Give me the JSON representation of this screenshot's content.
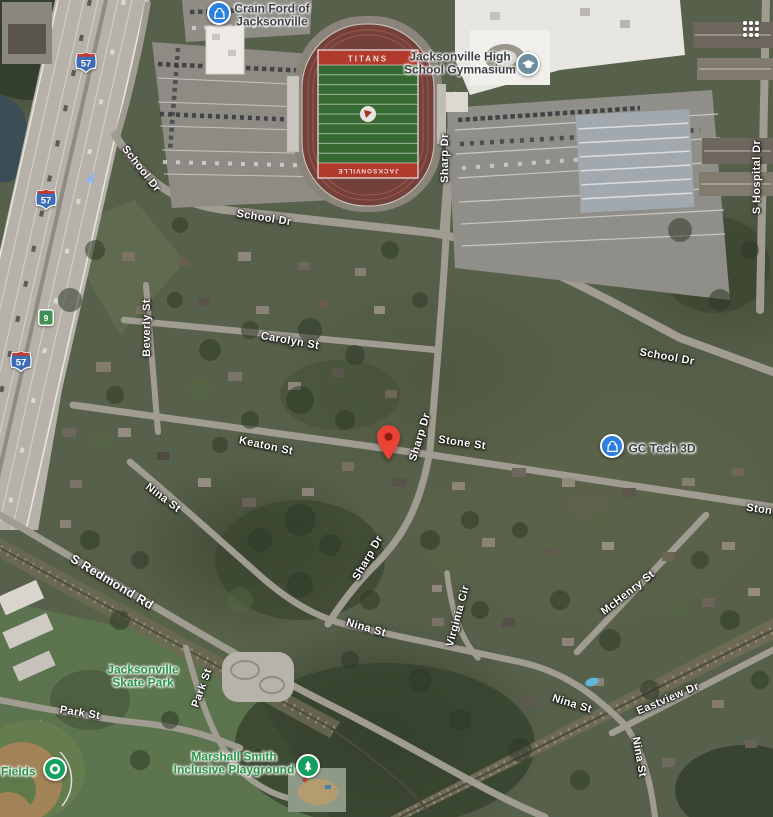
{
  "view": {
    "kind": "satellite-map",
    "city": "Jacksonville"
  },
  "controls": {
    "apps_grid_icon": "apps-grid"
  },
  "marker": {
    "name": "selected-location-pin",
    "color": "#EA4335"
  },
  "stadium": {
    "endzone_top": "TITANS",
    "endzone_bottom": "JACKSONVILLE"
  },
  "shields": [
    {
      "type": "interstate",
      "number": "57",
      "x": 86,
      "y": 64
    },
    {
      "type": "interstate",
      "number": "57",
      "x": 46,
      "y": 201
    },
    {
      "type": "state",
      "number": "9",
      "x": 46,
      "y": 320
    },
    {
      "type": "interstate",
      "number": "57",
      "x": 21,
      "y": 363
    }
  ],
  "street_labels": [
    {
      "text": "School Dr",
      "x": 141,
      "y": 169,
      "rot": 52
    },
    {
      "text": "School Dr",
      "x": 264,
      "y": 218,
      "rot": 9
    },
    {
      "text": "School Dr",
      "x": 667,
      "y": 357,
      "rot": 10
    },
    {
      "text": "Sharp Dr",
      "x": 445,
      "y": 158,
      "rot": -90
    },
    {
      "text": "Sharp Dr",
      "x": 420,
      "y": 437,
      "rot": -73
    },
    {
      "text": "Sharp Dr",
      "x": 368,
      "y": 558,
      "rot": -60
    },
    {
      "text": "Beverly St",
      "x": 147,
      "y": 328,
      "rot": -90
    },
    {
      "text": "Carolyn St",
      "x": 290,
      "y": 341,
      "rot": 10
    },
    {
      "text": "Keaton St",
      "x": 266,
      "y": 446,
      "rot": 12
    },
    {
      "text": "Stone St",
      "x": 462,
      "y": 443,
      "rot": 8
    },
    {
      "text": "Stone St",
      "x": 770,
      "y": 511,
      "rot": 8
    },
    {
      "text": "Nina St",
      "x": 163,
      "y": 498,
      "rot": 37
    },
    {
      "text": "S Redmond Rd",
      "x": 112,
      "y": 582,
      "rot": 31,
      "major": true
    },
    {
      "text": "Park St",
      "x": 202,
      "y": 688,
      "rot": -70
    },
    {
      "text": "Park St",
      "x": 80,
      "y": 713,
      "rot": 9
    },
    {
      "text": "Virginia Cir",
      "x": 458,
      "y": 616,
      "rot": -75
    },
    {
      "text": "McHenry St",
      "x": 628,
      "y": 593,
      "rot": -38
    },
    {
      "text": "Nina St",
      "x": 366,
      "y": 628,
      "rot": 16
    },
    {
      "text": "Nina St",
      "x": 572,
      "y": 704,
      "rot": 17
    },
    {
      "text": "Eastview Dr",
      "x": 668,
      "y": 699,
      "rot": -23
    },
    {
      "text": "Nina St",
      "x": 639,
      "y": 757,
      "rot": 80
    },
    {
      "text": "S Hospital Dr",
      "x": 757,
      "y": 177,
      "rot": -90
    }
  ],
  "pois": {
    "crain_ford": {
      "line1": "Crain Ford of",
      "line2": "Jacksonville",
      "icon": "shopping-bag",
      "icon_color": "#2a7fe0"
    },
    "gymnasium": {
      "line1": "Jacksonville High",
      "line2": "School Gymnasium",
      "icon": "graduation-cap",
      "icon_color": "#6f8e9b"
    },
    "gc_tech": {
      "line1": "GC Tech 3D",
      "icon": "shopping-bag",
      "icon_color": "#2a7fe0"
    },
    "skate_park": {
      "line1": "Jacksonville",
      "line2": "Skate Park"
    },
    "playground": {
      "line1": "Marshall Smith",
      "line2": "Inclusive Playground",
      "icon": "tree",
      "icon_color": "#12a05f"
    },
    "fields": {
      "line1": "l Fields",
      "icon": "dot",
      "icon_color": "#12a05f"
    }
  }
}
